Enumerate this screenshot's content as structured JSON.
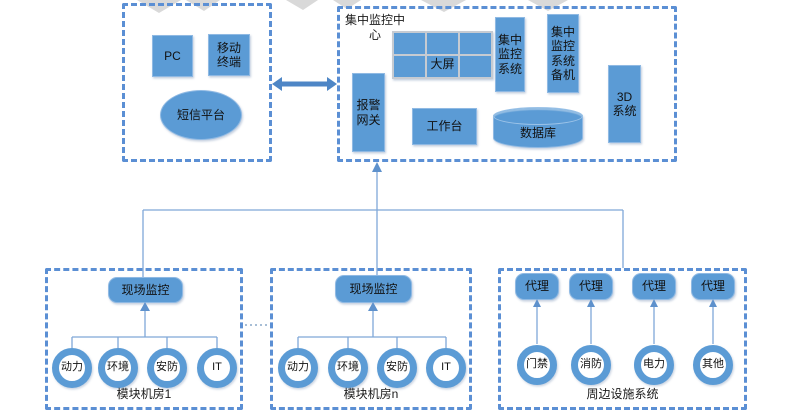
{
  "colors": {
    "shape_fill": "#5b9bd5",
    "dashed_border": "#5b8fd4",
    "connector_line": "#7fa8d8",
    "double_arrow": "#4e86c6",
    "text": "#1a1a1a"
  },
  "clients": {
    "pc": "PC",
    "mobile_terminal": "移动终端",
    "sms_platform": "短信平台"
  },
  "center": {
    "title": "集中监控中心",
    "alarm_gateway": "报警网关",
    "big_screen": "大屏",
    "workbench": "工作台",
    "monitoring_system": "集中监控系统",
    "monitoring_backup": "集中监控系统备机",
    "database": "数据库",
    "system_3d": "3D系统"
  },
  "module_room_1": {
    "onsite": "现场监控",
    "nodes": [
      "动力",
      "环境",
      "安防",
      "IT"
    ],
    "label": "模块机房1"
  },
  "module_room_n": {
    "onsite": "现场监控",
    "nodes": [
      "动力",
      "环境",
      "安防",
      "IT"
    ],
    "label": "模块机房n"
  },
  "peripheral": {
    "agents": [
      "代理",
      "代理",
      "代理",
      "代理"
    ],
    "nodes": [
      "门禁",
      "消防",
      "电力",
      "其他"
    ],
    "label": "周边设施系统"
  }
}
